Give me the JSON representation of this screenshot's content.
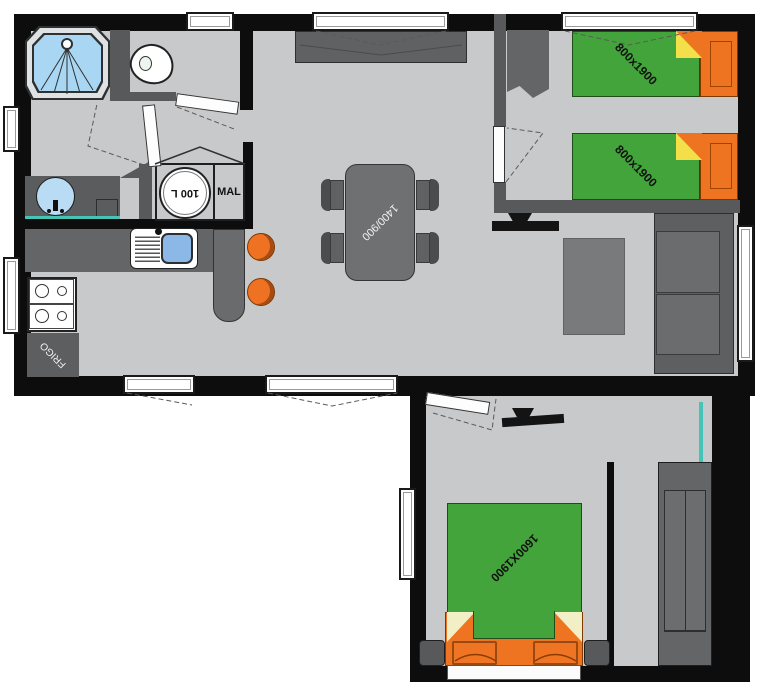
{
  "type": "floor-plan",
  "labels": {
    "dining_table": "1400/900",
    "twin_bed_1": "800x1900",
    "twin_bed_2": "800x1900",
    "double_bed": "1600X1900",
    "boiler": "100 L",
    "washing_machine": "MAL",
    "fridge": "FRIGO"
  },
  "colors": {
    "wall": "#0d0d0d",
    "partition": "#58595b",
    "floor": "#c8c9cb",
    "furniture_gray": "#646567",
    "bed_green": "#44a43c",
    "bed_orange": "#ee7422",
    "fold_yellow": "#f3df49",
    "pillow_cream": "#f2eec6",
    "shower_blue": "#a9d6f2",
    "basin_blue": "#8cb8e8",
    "mirror_teal": "#45c4b5",
    "window_white": "#ffffff"
  }
}
